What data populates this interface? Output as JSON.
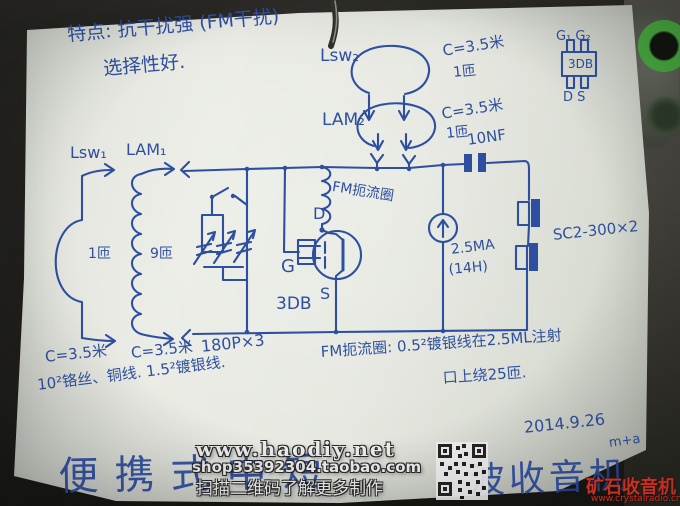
{
  "colors": {
    "ink_blue": "#2e4f9f",
    "paper_white": "#e7e9e2",
    "table_dark": "#22211d",
    "brand_red": "#e8392a",
    "cap_green": "#49b441"
  },
  "notes_top": {
    "line1": "特点: 抗干扰强 (FM干扰)",
    "line2": "选择性好."
  },
  "antenna_top": {
    "lsw2": "Lsw₂",
    "lsw2_spec": "C=3.5米",
    "lsw2_turns": "1匝",
    "lam2": "LAM₂",
    "lam2_spec": "C=3.5米",
    "lam2_turns": "1匝",
    "coupling_cap": "10NF"
  },
  "mosfet_package": {
    "gates": "G₁ G₂",
    "model": "3DB",
    "pins": "D S"
  },
  "tank": {
    "lsw1": "Lsw₁",
    "lsw1_turns": "1匝",
    "lam1": "LAM₁",
    "lam1_turns": "9匝"
  },
  "mosfet": {
    "d": "D",
    "g": "G",
    "s": "S",
    "model": "3DB"
  },
  "choke_label": "FM扼流圈",
  "bias": {
    "current": "2.5MA",
    "inductance": "(14H)"
  },
  "earphone_label": "SC2-300×2",
  "bottom_notes": {
    "c_left": "C=3.5米",
    "c_mid": "C=3.5米",
    "varcap": "180P×3",
    "wire_spec": "10²铬丝、铜线. 1.5²镀银线.",
    "choke_note1": "FM扼流圈: 0.5²镀银线在2.5ML注射",
    "choke_note2": "口上绕25匝.",
    "date": "2014.9.26",
    "signature": "m+a"
  },
  "title_bottom": {
    "left": "便携式中短",
    "right": "波收音机"
  },
  "watermark": {
    "site": "www.haodiy.net",
    "shop": "shop35392304.taobao.com",
    "scan": "扫描二维码了解更多制作"
  },
  "brand": {
    "name": "矿石收音机",
    "url": "www.crystalradio.cn"
  }
}
